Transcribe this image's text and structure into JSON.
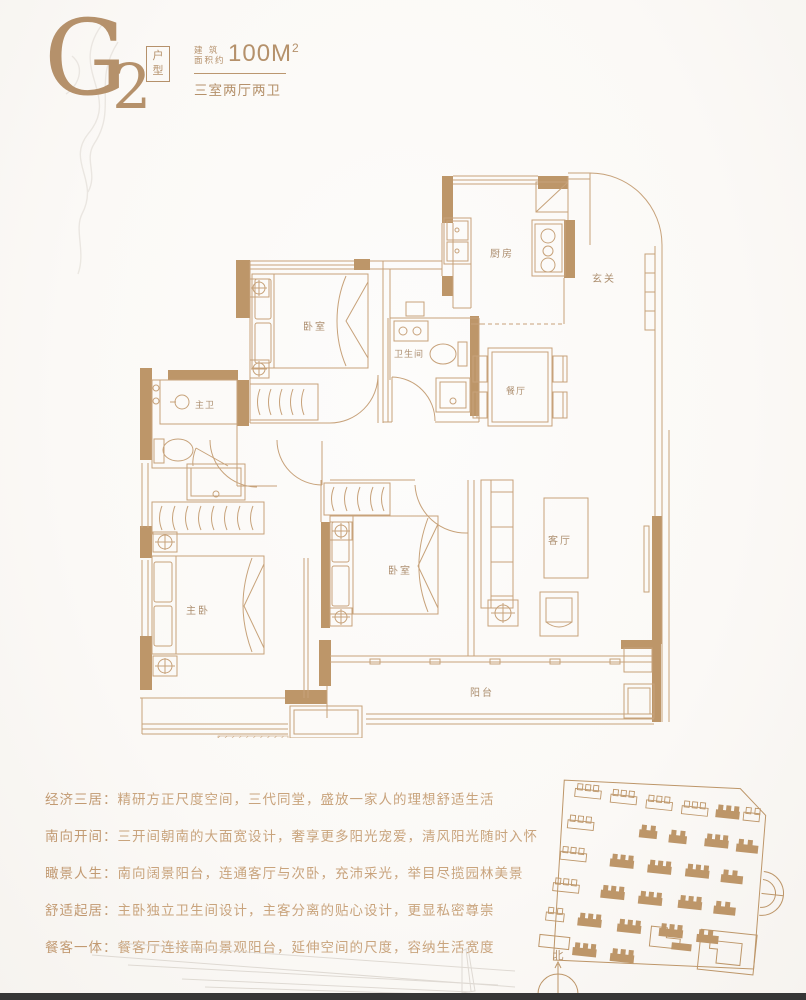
{
  "header": {
    "unit_letter": "G",
    "unit_number": "2",
    "unit_box_char1": "户",
    "unit_box_char2": "型",
    "area_label_line1": "建 筑",
    "area_label_line2": "面积约",
    "area_value": "100M",
    "area_sup": "2",
    "layout_summary": "三室两厅两卫"
  },
  "floor_plan": {
    "labels": {
      "kitchen": "厨房",
      "foyer": "玄关",
      "bedroom_north": "卧室",
      "bathroom": "卫生间",
      "master_bath": "主卫",
      "dining": "餐厅",
      "master_bedroom": "主卧",
      "bedroom_south": "卧室",
      "living_room": "客厅",
      "balcony": "阳台"
    }
  },
  "features": [
    {
      "label": "经济三居：",
      "text": "精研方正尺度空间，三代同堂，盛放一家人的理想舒适生活"
    },
    {
      "label": "南向开间：",
      "text": "三开间朝南的大面宽设计，奢享更多阳光宠爱，清风阳光随时入怀"
    },
    {
      "label": "瞰景人生：",
      "text": "南向阔景阳台，连通客厅与次卧，充沛采光，举目尽揽园林美景"
    },
    {
      "label": "舒适起居：",
      "text": "主卧独立卫生间设计，主客分离的贴心设计，更显私密尊崇"
    },
    {
      "label": "餐客一体：",
      "text": "餐客厅连接南向景观阳台，延伸空间的尺度，容纳生活宽度"
    }
  ],
  "site_plan": {
    "compass_label": "北",
    "buildings": [
      {
        "x": 28,
        "y": 24,
        "w": 26,
        "f": 0
      },
      {
        "x": 64,
        "y": 26,
        "w": 26,
        "f": 0
      },
      {
        "x": 100,
        "y": 28,
        "w": 26,
        "f": 0
      },
      {
        "x": 136,
        "y": 30,
        "w": 26,
        "f": 0
      },
      {
        "x": 170,
        "y": 30,
        "w": 24,
        "f": 1
      },
      {
        "x": 198,
        "y": 30,
        "w": 16,
        "f": 0
      },
      {
        "x": 24,
        "y": 56,
        "w": 26,
        "f": 0
      },
      {
        "x": 96,
        "y": 58,
        "w": 18,
        "f": 1
      },
      {
        "x": 126,
        "y": 60,
        "w": 18,
        "f": 1
      },
      {
        "x": 162,
        "y": 60,
        "w": 24,
        "f": 1
      },
      {
        "x": 194,
        "y": 62,
        "w": 22,
        "f": 1
      },
      {
        "x": 20,
        "y": 88,
        "w": 26,
        "f": 0
      },
      {
        "x": 70,
        "y": 90,
        "w": 24,
        "f": 1
      },
      {
        "x": 108,
        "y": 92,
        "w": 24,
        "f": 1
      },
      {
        "x": 146,
        "y": 92,
        "w": 24,
        "f": 1
      },
      {
        "x": 182,
        "y": 94,
        "w": 22,
        "f": 1
      },
      {
        "x": 16,
        "y": 120,
        "w": 26,
        "f": 0
      },
      {
        "x": 64,
        "y": 122,
        "w": 24,
        "f": 1
      },
      {
        "x": 102,
        "y": 124,
        "w": 24,
        "f": 1
      },
      {
        "x": 142,
        "y": 124,
        "w": 24,
        "f": 1
      },
      {
        "x": 178,
        "y": 126,
        "w": 22,
        "f": 1
      },
      {
        "x": 12,
        "y": 150,
        "w": 18,
        "f": 0
      },
      {
        "x": 44,
        "y": 152,
        "w": 24,
        "f": 1
      },
      {
        "x": 84,
        "y": 154,
        "w": 24,
        "f": 1
      },
      {
        "x": 126,
        "y": 154,
        "w": 24,
        "f": 1
      },
      {
        "x": 164,
        "y": 156,
        "w": 22,
        "f": 1
      },
      {
        "x": 42,
        "y": 182,
        "w": 24,
        "f": 1
      },
      {
        "x": 80,
        "y": 184,
        "w": 24,
        "f": 1
      }
    ]
  },
  "colors": {
    "accent": "#b5916b",
    "wall_fill": "#bd9669",
    "plan_line": "#c7a27a",
    "plan_label": "#ad8f70",
    "feature_text": "#c9a47d"
  }
}
